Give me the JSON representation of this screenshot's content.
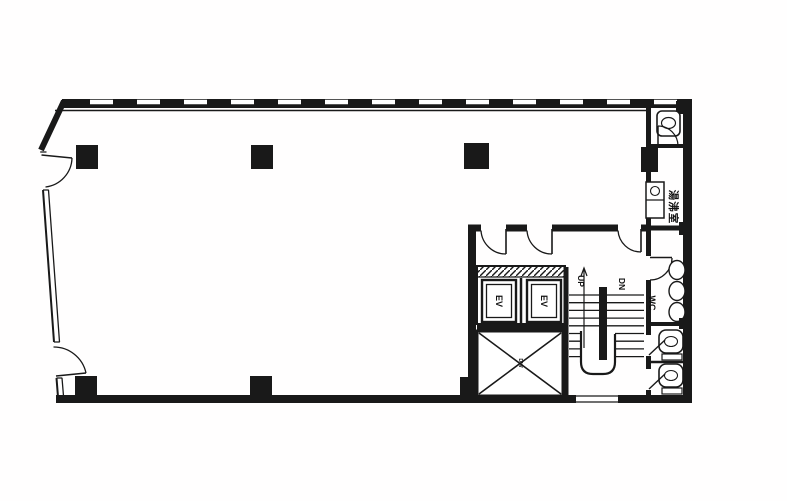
{
  "meta": {
    "document_type": "building floor plan (scanned)",
    "background_color": "#ffffff",
    "ink_color": "#1c1c1c"
  },
  "core": {
    "elevators": [
      {
        "label": "EV"
      },
      {
        "label": "EV"
      }
    ],
    "stairs": {
      "up_label": "UP",
      "down_label": "DN"
    },
    "dumbwaiter_label": "DW"
  },
  "rooms": {
    "wc_label": "WC",
    "kitchenette_label": "湯沸室"
  }
}
